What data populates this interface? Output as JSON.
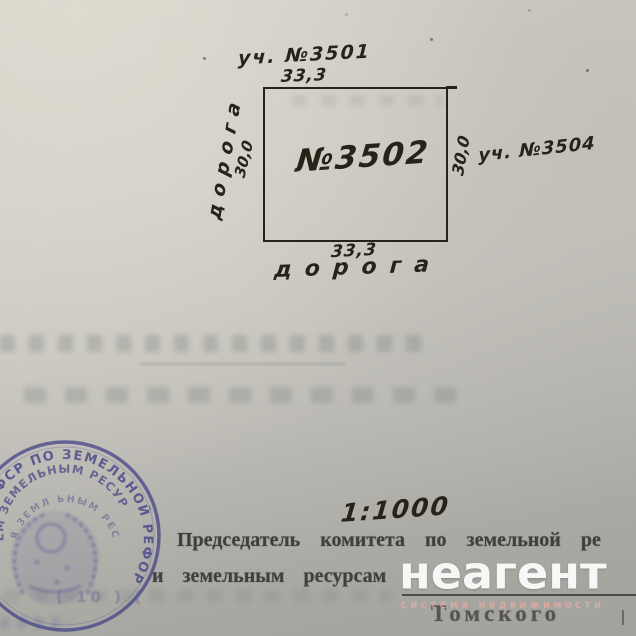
{
  "plot_plan": {
    "top_neighbor_label": "уч. №3501",
    "top_dimension": "33,3",
    "plot_number": "№3502",
    "left_road_label": "дорога",
    "left_dimension": "30,0",
    "right_dimension": "30,0",
    "right_neighbor_label": "уч. №3504",
    "bottom_dimension": "33,3",
    "bottom_road_label": "дорога",
    "ink_color": "#262419"
  },
  "scale_note": "1:1000",
  "signature_block": {
    "line1": "Председатель комитета по земельной  ре",
    "line2": "и земельным ресурсам",
    "line3": "Томского"
  },
  "stamp": {
    "arc_outer": "ЕТ РСФСР ПО ЗЕМЕЛЬНОЙ РЕФОР",
    "arc_middle": "ЕМ ЗЕМЕЛЬНЫМ РЕСУР",
    "arc_inner": "Я ЗЕМЛ ЬНЫМ РЕС",
    "bottom_marks": "( 10 ) (",
    "ink_color": "#4d4d8c"
  },
  "watermark": {
    "brand": "неагент",
    "tagline": "система недвижимости"
  }
}
